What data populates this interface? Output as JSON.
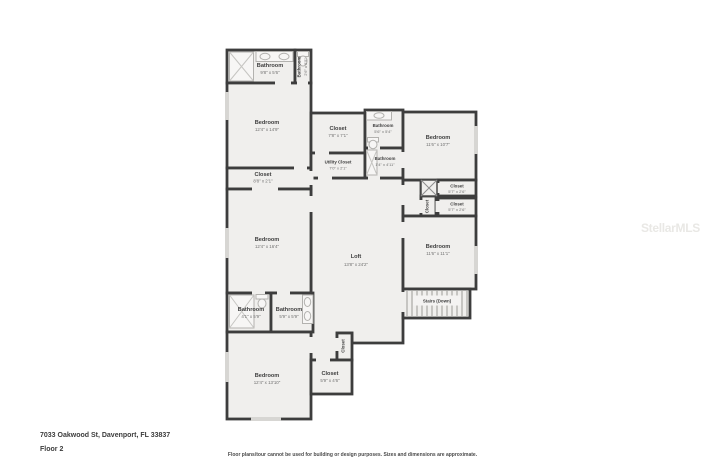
{
  "colors": {
    "wall": "#3d3d3d",
    "room_fill": "#f0efed",
    "window": "#d7d6d3",
    "label": "#3e3e3e"
  },
  "rooms": {
    "bathroom_master": {
      "name": "Bathroom",
      "dims": "9'8\" x 5'6\""
    },
    "bathroom_top": {
      "name": "Bathroom",
      "dims": "2'6\" x 5'5\""
    },
    "bedroom_top_left": {
      "name": "Bedroom",
      "dims": "12'4\" x 14'9\""
    },
    "closet_hall": {
      "name": "Closet",
      "dims": "7'8\" x 7'1\""
    },
    "bathroom_hall": {
      "name": "Bathroom",
      "dims": "5'6\" x 5'4\""
    },
    "utility_closet": {
      "name": "Utility Closet",
      "dims": "7'0\" x 2'1\""
    },
    "bathroom_narrow": {
      "name": "Bathroom",
      "dims": "1'4\" x 4'11\""
    },
    "bedroom_top_right": {
      "name": "Bedroom",
      "dims": "11'6\" x 10'7\""
    },
    "closet_mid_left": {
      "name": "Closet",
      "dims": "8'8\" x 2'1\""
    },
    "closet_right_1": {
      "name": "Closet",
      "dims": "5'7\" x 2'6\""
    },
    "closet_right_2": {
      "name": "Closet",
      "dims": "5'7\" x 2'6\""
    },
    "closet_right_vert": {
      "name": "Closet"
    },
    "bedroom_mid_left": {
      "name": "Bedroom",
      "dims": "12'4\" x 16'4\""
    },
    "bedroom_mid_right": {
      "name": "Bedroom",
      "dims": "11'6\" x 11'1\""
    },
    "loft": {
      "name": "Loft",
      "dims": "13'8\" x 24'2\""
    },
    "stairs": {
      "name": "Stairs (Down)"
    },
    "bathroom_bottom_left": {
      "name": "Bathroom",
      "dims": "4'1\" x 5'9\""
    },
    "bathroom_bottom_right": {
      "name": "Bathroom",
      "dims": "5'9\" x 5'9\""
    },
    "closet_bottom_vert": {
      "name": "Closet"
    },
    "closet_bottom": {
      "name": "Closet",
      "dims": "5'9\" x 4'6\""
    },
    "bedroom_bottom": {
      "name": "Bedroom",
      "dims": "12'4\" x 13'10\""
    }
  },
  "footer": {
    "address": "7033 Oakwood St, Davenport, FL 33837",
    "floor": "Floor 2",
    "disclaimer": "Floor plans/tour cannot be used for building or design purposes. Sizes and dimensions are approximate.",
    "watermark": "StellarMLS"
  }
}
